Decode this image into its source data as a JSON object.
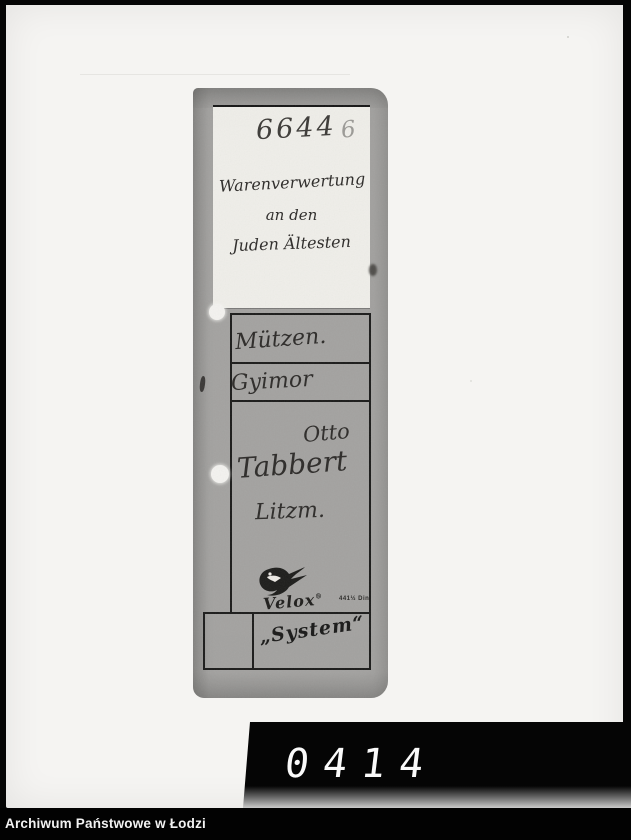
{
  "photo": {
    "folder": {
      "label": {
        "archive_number": "6644",
        "page_number": "6",
        "title_line1": "Warenverwertung",
        "title_line2": "an den",
        "title_line3": "Juden Ältesten"
      },
      "fields": {
        "field1": "Mützen.",
        "field2": "Gyimor",
        "field3": "Otto",
        "field4": "Tabbert",
        "field5": "Litzm."
      },
      "brand": {
        "logo": "swallow-icon",
        "name": "Velox",
        "registered_mark": "®",
        "din_note": "441½ Din",
        "system_label": "„System“"
      }
    }
  },
  "counter": {
    "digits": [
      "0",
      "4",
      "1",
      "4"
    ]
  },
  "footer": {
    "caption": "Archiwum Państwowe w Łodzi"
  },
  "colors": {
    "background": "#050505",
    "photo_paper": "#f5f4f2",
    "folder_gray": "#a3a2a0",
    "ink": "#2d2b29",
    "rule_line": "#1b1b1a",
    "counter_digits": "#fafafa",
    "caption_text": "#f2f2f2"
  }
}
